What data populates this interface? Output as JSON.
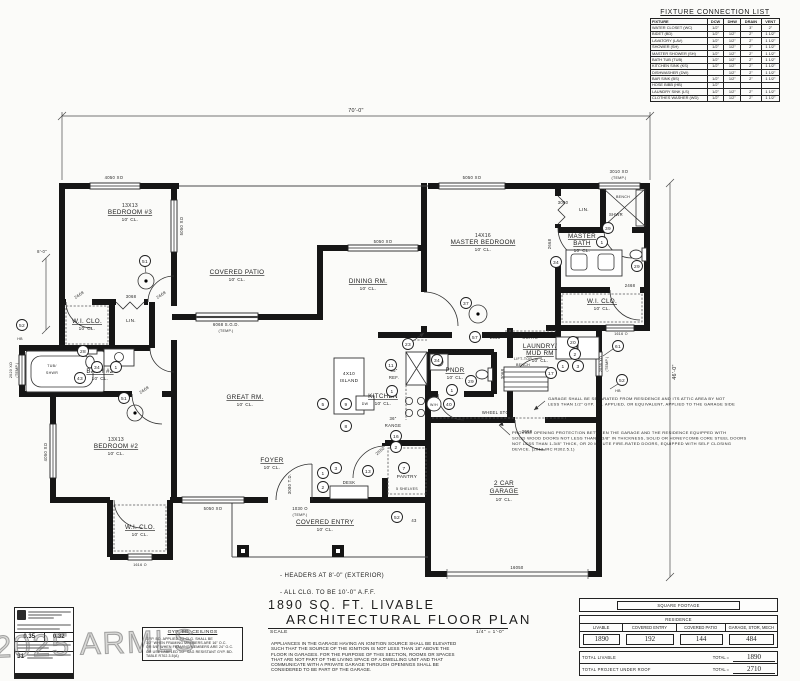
{
  "watermark": "2025 ARMLS",
  "fixture_table": {
    "title": "FIXTURE CONNECTION LIST",
    "headers": [
      "FIXTURE",
      "DCW",
      "DHW",
      "DRAIN",
      "VENT"
    ],
    "rows": [
      {
        "f": "WATER CLOSET (WC)",
        "dcw": "1/2\"",
        "dhw": "",
        "dr": "3\"",
        "v": "2\""
      },
      {
        "f": "BIDET (BD)",
        "dcw": "1/2\"",
        "dhw": "1/2\"",
        "dr": "2\"",
        "v": "1 1/2\""
      },
      {
        "f": "LAVATORY (LAV)",
        "dcw": "1/2\"",
        "dhw": "1/2\"",
        "dr": "2\"",
        "v": "1 1/2\""
      },
      {
        "f": "SHOWER (SH)",
        "dcw": "1/2\"",
        "dhw": "1/2\"",
        "dr": "2\"",
        "v": "1 1/2\""
      },
      {
        "f": "MASTER SHOWER (SH)",
        "dcw": "1/2\"",
        "dhw": "1/2\"",
        "dr": "2\"",
        "v": "1 1/2\""
      },
      {
        "f": "BATH TUB (TUB)",
        "dcw": "1/2\"",
        "dhw": "1/2\"",
        "dr": "2\"",
        "v": "1 1/2\""
      },
      {
        "f": "KITCHEN SINK (KS)",
        "dcw": "1/2\"",
        "dhw": "1/2\"",
        "dr": "2\"",
        "v": "1 1/2\""
      },
      {
        "f": "DISHWASHER (DW)",
        "dcw": "",
        "dhw": "1/2\"",
        "dr": "2\"",
        "v": "1 1/2\""
      },
      {
        "f": "BAR SINK (BS)",
        "dcw": "1/2\"",
        "dhw": "1/2\"",
        "dr": "2\"",
        "v": "1 1/2\""
      },
      {
        "f": "HOSE BIBB (HB)",
        "dcw": "1/2\"",
        "dhw": "",
        "dr": "",
        "v": ""
      },
      {
        "f": "LAUNDRY SINK (LS)",
        "dcw": "1/2\"",
        "dhw": "1/2\"",
        "dr": "2\"",
        "v": "1 1/2\""
      },
      {
        "f": "CLOTHES WASHER (WD)",
        "dcw": "1/2\"",
        "dhw": "1/2\"",
        "dr": "2\"",
        "v": "1 1/2\""
      }
    ]
  },
  "plan": {
    "dims": {
      "top": "70'-0\"",
      "right": "46'-0\"",
      "left": "8'-0\""
    },
    "misc43": "43",
    "rooms": {
      "b3": {
        "size": "13X13",
        "name": "BEDROOM #3",
        "ceil": "10' CL."
      },
      "patio": {
        "name": "COVERED PATIO",
        "ceil": "10' CL."
      },
      "dining": {
        "name": "DINING RM.",
        "ceil": "10' CL."
      },
      "master": {
        "size": "14X16",
        "name": "MASTER BEDROOM",
        "ceil": "10' CL."
      },
      "mbath": {
        "l1": "MASTER",
        "l2": "BATH",
        "ceil": "10' CL."
      },
      "wiclom": {
        "name": "W.I. CLO.",
        "ceil": "10' CL."
      },
      "linm": "LIN.",
      "great": {
        "name": "GREAT RM.",
        "ceil": "10' CL."
      },
      "kitchen": {
        "name": "KITCHEN",
        "ceil": "10' CL."
      },
      "island": {
        "l1": "4X10",
        "l2": "ISLAND"
      },
      "foyer": {
        "name": "FOYER",
        "ceil": "10' CL."
      },
      "pantry": {
        "name": "PANTRY",
        "shelves": "5 SHELVES"
      },
      "entry": {
        "name": "COVERED ENTRY",
        "ceil": "10' CL."
      },
      "laundry": {
        "l1": "LAUNDRY/",
        "l2": "MUD RM",
        "ceil": "10' CL."
      },
      "pndr": {
        "name": "PNDR",
        "ceil": "10' CL."
      },
      "garage": {
        "l1": "2 CAR",
        "l2": "GARAGE",
        "ceil": "10' CL."
      },
      "bath2": {
        "name": "BATH #2",
        "ceil": "10' CL."
      },
      "tub": {
        "l1": "TUB/",
        "l2": "SHWR"
      },
      "wiclo2": {
        "name": "W.I. CLO.",
        "ceil": "10' CL."
      },
      "lin2": "LIN.",
      "b2": {
        "size": "13X13",
        "name": "BEDROOM #2",
        "ceil": "10' CL."
      },
      "wiclo3": {
        "name": "W.I. CLO.",
        "ceil": "10' CL."
      },
      "bench": "BENCH",
      "shwr": "SHWR",
      "coats": "COATS",
      "lift": {
        "l1": "LIFT-TOP",
        "l2": "BENCH"
      },
      "desk": "DESK",
      "ref": {
        "l1": "36\"",
        "l2": "REF."
      },
      "range": {
        "l1": "36\"",
        "l2": "RANGE"
      },
      "wh": "W/H",
      "wheel": "WHEEL STOP",
      "hb": "HB",
      "dw": "DW"
    },
    "openings": {
      "w4050": "4050 XO",
      "w5050": "5050 XO",
      "w3010": "3010 XO",
      "w3060": "3060",
      "w2036": "2036 XO",
      "w2020": "2020 XO",
      "w1616": "1616 O",
      "w1030": "1030 O",
      "temp": "(TEMP.)",
      "sgd": "6068 S.G.D.",
      "d2668": "2668",
      "d2468": "2468",
      "d3068": "3068",
      "d3080": "3080 T.D.",
      "d16050": "16050",
      "d2550": "2550"
    },
    "keynotes": {
      "k1": "1",
      "k2": "2",
      "k3": "3",
      "k5": "5",
      "k7": "7",
      "k8": "8",
      "k9": "9",
      "k11": "11",
      "k13": "13",
      "k16": "16",
      "k17": "17",
      "k20": "20",
      "k21": "21",
      "k23": "23",
      "k28": "28",
      "k29": "29",
      "k34": "34",
      "k37": "37",
      "k39": "39",
      "k40": "40",
      "k43": "43",
      "k51": "51",
      "k52": "52",
      "k57": "57",
      "k61": "61"
    },
    "notes": {
      "sep": [
        "GARAGE SHALL BE SEPARATED FROM RESIDENCE AND ITS ATTIC AREA BY NOT",
        "LESS THAN 1/2\" GYP. BD. APPLIED, OR EQUIVALENT, APPLIED TO THE GARAGE SIDE"
      ],
      "prot": [
        "PROVIDE OPENING PROTECTION BETWEEN THE GARAGE AND THE RESIDENCE EQUIPPED WITH",
        "SOLID WOOD DOORS NOT LESS THAN 1-3/8\" IN THICKNESS, SOLID OR HONEYCOMB CORE STEEL DOORS",
        "NOT LESS THAN 1-3/8\" THICK, OR 20 MINUTE FIRE-RATED DOORS, EQUIPPED WITH SELF CLOSING",
        "DEVICE. (2012 IRC R302.5.1)"
      ]
    }
  },
  "titleblock": {
    "note1": "- HEADERS AT 8'-0\" (EXTERIOR)",
    "note2": "- ALL CLG. TO BE 10'-0\" A.F.F.",
    "title1": "1890 SQ. FT. LIVABLE",
    "title2": "ARCHITECTURAL FLOOR PLAN",
    "scale_label": "SCALE",
    "scale_value": "1/4\" = 1'-0\"",
    "appliance_note": [
      "APPLIANCES IN THE GARAGE HAVING AN IGNITION SOURCE SHALL BE ELEVATED",
      "SUCH THAT THE SOURCE OF THE IGNITION IS NOT LESS THAN 18\" ABOVE THE",
      "FLOOR IN GARAGES. FOR THE PURPOSE OF THIS SECTION, ROOMS OR SPACES",
      "THAT ARE NOT PART OF THE LIVING SPACE OF A DWELLING UNIT AND THAT",
      "COMMUNICATE WITH A PRIVATE GARAGE THROUGH OPENINGS SHALL BE",
      "CONSIDERED TO BE PART OF THE GARAGE."
    ]
  },
  "gyp_note": {
    "title": "GYP. BD. CEILINGS",
    "lines": [
      "GYP. BD. APPLIED TO CLG. SHALL BE",
      "1/2\" WHEN FRAMING MEMBERS ARE 16\" O.C.",
      "OR 5/8\" WHEN FRAMING MEMBERS ARE 24\" O.C.",
      "OR USE LABELED 1/2\" SAG RESISTANT GYP. BD.",
      "TABLE R702.3.5(A)"
    ]
  },
  "stamp": {
    "v1": "0.35",
    "v2": "0.32",
    "v3": "31"
  },
  "sqft_table": {
    "title": "SQUARE FOOTAGE",
    "subtitle": "RESIDENCE",
    "headers": [
      "LIVABLE",
      "COVERED ENTRY",
      "COVERED PATIO",
      "GARAGE, STOR, MECH"
    ],
    "values": [
      "1890",
      "192",
      "144",
      "484"
    ],
    "total_livable_label": "TOTAL LIVABLE",
    "total_roof_label": "TOTAL PROJECT UNDER ROOF",
    "total_eq": "TOTAL =",
    "total_livable": "1890",
    "total_roof": "2710"
  }
}
